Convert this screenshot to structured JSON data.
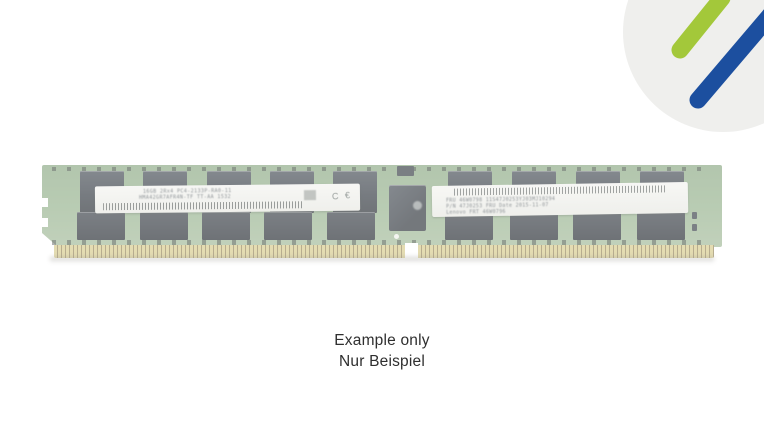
{
  "window": {
    "background_color": "#ffffff"
  },
  "brand_logo": {
    "name": "corner-brand-watermark",
    "circle_color": "#efefed",
    "stripe_green": "#a3c83a",
    "stripe_blue": "#1c4f9f"
  },
  "product_image": {
    "description": "DDR4 registered DIMM memory module, faded example photo",
    "pcb_color": "#84a37c",
    "chip_color": "#242b33",
    "pin_color": "#d4c784",
    "hynix_label": {
      "line1": "16GB 2Rx4 PC4-2133P-RA0-11",
      "line2": "HMA42GR7AFR4N-TF TT-AA 1532",
      "ce_mark": "C €"
    },
    "fru_label": {
      "line1": "FRU 46W0798      11S47J0253YJ03MJ10294",
      "line2": "P/N 47J0253      FRU Date 2015-11-07",
      "line3": "Lenovo FRT 46W0796"
    }
  },
  "caption": {
    "line1": "Example only",
    "line2": "Nur Beispiel",
    "text_color": "#2f2f2f"
  }
}
